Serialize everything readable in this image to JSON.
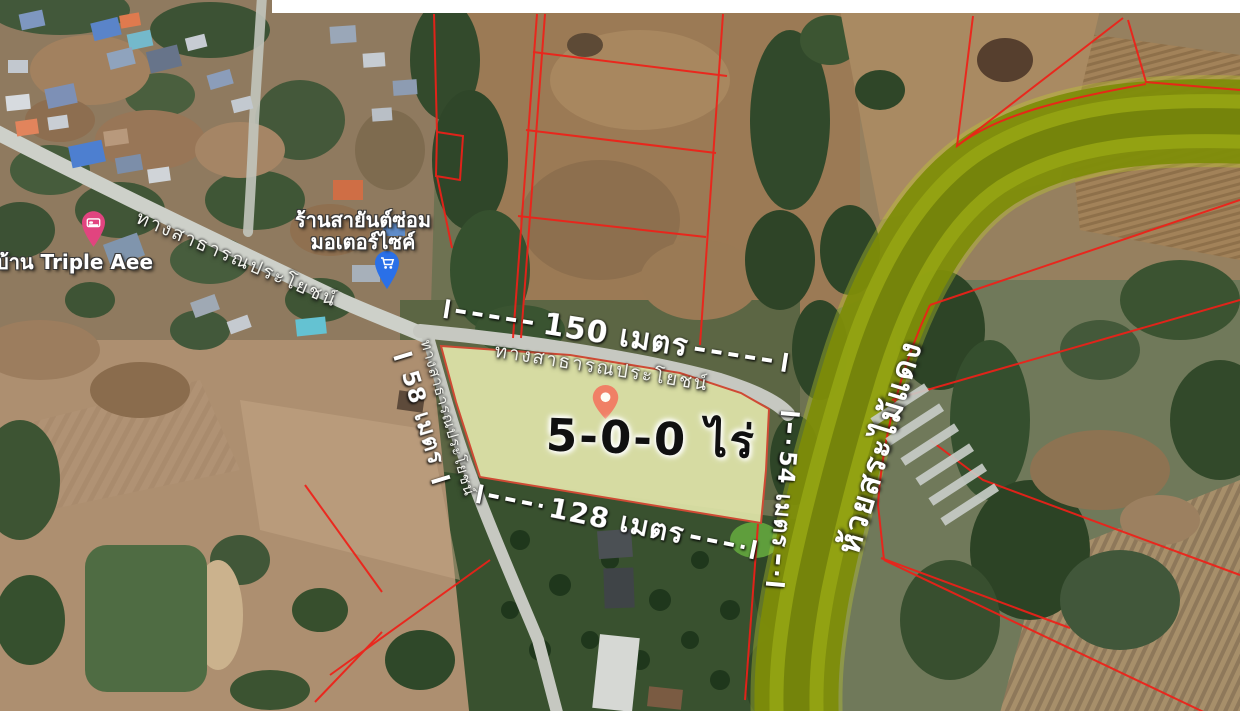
{
  "map": {
    "area_label": "5-0-0 ไร่",
    "dimensions": {
      "top": "150 เมตร",
      "bottom": "128 เมตร",
      "left": "58 เมตร",
      "right": "54 เมตร"
    },
    "roads": {
      "village": "ทางสาธารณประโยชน์",
      "plot_top": "ทางสาธารณประโยชน์",
      "south": "ทางสาธารณประโยชน์"
    },
    "river_name": "ห้วยสระไม้แดง",
    "places": {
      "lodging_name": "บ้าน Triple Aee",
      "shop_name_line1": "ร้านสายันต์ซ่อม",
      "shop_name_line2": "มอเตอร์ไซค์"
    },
    "icons": {
      "plot_pin": "location-pin-icon",
      "lodging_pin": "bed-pin-icon",
      "shop_pin": "shopping-cart-pin-icon"
    },
    "colors": {
      "plot_highlight": "#e0e4a9",
      "plot_outline": "#cf4a34",
      "parcel_boundary_red": "#ef2018",
      "river_highlight": "#8a9a10",
      "annotation_white": "#ffffff",
      "plot_pin": "#f08066",
      "lodging_pin": "#e1447f",
      "shop_pin": "#2a70e8"
    }
  }
}
